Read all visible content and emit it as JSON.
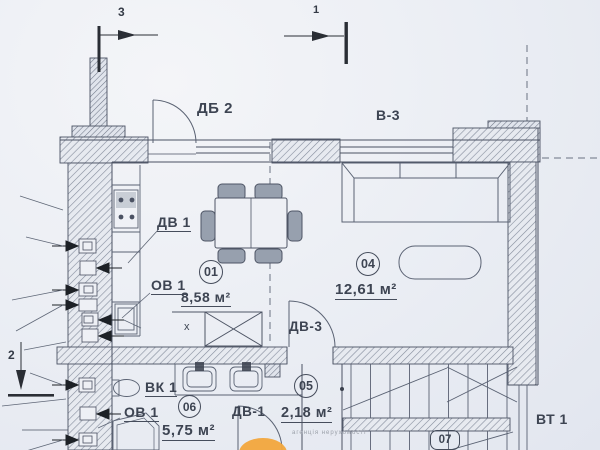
{
  "axes": {
    "top_left": "3",
    "top_center": "1",
    "left": "2"
  },
  "openings": {
    "balcony_door": "ДБ 2",
    "living_window": "В-3",
    "kitchen_door": "ДВ 1",
    "kitchen_window": "ОВ 1",
    "vent_channel": "ВК 1",
    "bath_window": "ОВ 1",
    "bath_door": "ДВ-1",
    "hall_door": "ДВ-3",
    "stair_vent": "ВТ 1"
  },
  "rooms": {
    "r01": {
      "number": "01",
      "area": "8,58 м²"
    },
    "r04": {
      "number": "04",
      "area": "12,61 м²"
    },
    "r05": {
      "number": "05",
      "area": "2,18 м²"
    },
    "r06": {
      "number": "06",
      "area": "5,75 м²"
    },
    "r07": {
      "number": "07"
    }
  },
  "marks": {
    "x": "х"
  },
  "watermark": {
    "text": "агенція нерухомості"
  },
  "colors": {
    "ink": "#3d4452",
    "paper": "#eceef4",
    "accent_orange": "#f2a63c"
  }
}
